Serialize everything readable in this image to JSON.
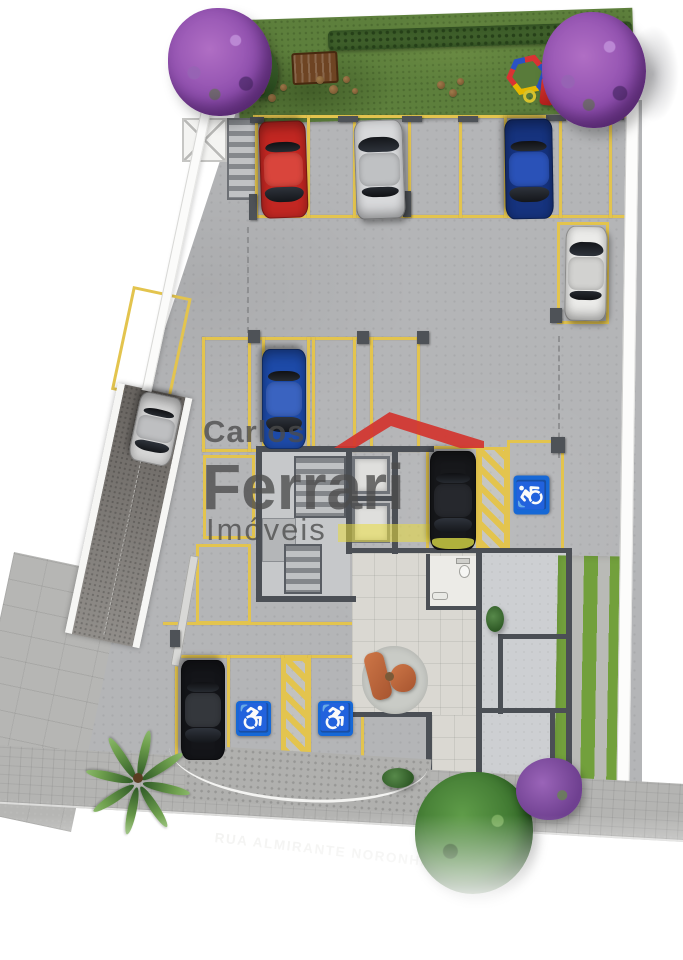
{
  "scene": {
    "type": "architectural-site-plan",
    "description": "Ground-floor parking site plan render",
    "features": [
      "lawn",
      "bench",
      "playground",
      "purple-trees",
      "parking-spots",
      "ramp",
      "stair-core",
      "elevators",
      "lobby",
      "garden-strips",
      "street"
    ]
  },
  "street": {
    "name": "RUA ALMIRANTE NORONHA"
  },
  "watermark": {
    "line1": "Carlos",
    "line2": "Ferrari",
    "line3": "Imóveis"
  },
  "accessibility": {
    "wheelchair_glyph": "♿",
    "accessible_spots": 3
  },
  "colors": {
    "line_yellow": "#e3c44e",
    "asphalt": "#b4b5b7",
    "grass": "#5d7f3c",
    "street": "#3f3f3f",
    "sidewalk": "#b4b4b2",
    "wall": "#4b4f55",
    "handicap_blue": "#1668d6",
    "logo_red": "#d2342e"
  },
  "plan": {
    "yellow_lines": [
      [
        253,
        115,
        380,
        3
      ],
      [
        253,
        215,
        380,
        3
      ],
      [
        255,
        115,
        3,
        103
      ],
      [
        307,
        115,
        3,
        103
      ],
      [
        353,
        115,
        3,
        103
      ],
      [
        408,
        115,
        3,
        103
      ],
      [
        459,
        115,
        3,
        103
      ],
      [
        504,
        115,
        3,
        103
      ],
      [
        559,
        115,
        3,
        103
      ],
      [
        609,
        115,
        3,
        103
      ],
      [
        202,
        337,
        218,
        3
      ],
      [
        202,
        449,
        218,
        3
      ],
      [
        202,
        337,
        3,
        115
      ],
      [
        248,
        337,
        3,
        115
      ],
      [
        262,
        337,
        3,
        115
      ],
      [
        307,
        337,
        3,
        115
      ],
      [
        312,
        337,
        3,
        115
      ],
      [
        353,
        337,
        3,
        115
      ],
      [
        370,
        337,
        3,
        115
      ],
      [
        417,
        337,
        3,
        115
      ],
      [
        163,
        622,
        208,
        3
      ],
      [
        175,
        655,
        195,
        3
      ],
      [
        175,
        757,
        195,
        3
      ],
      [
        175,
        655,
        3,
        105
      ],
      [
        227,
        655,
        3,
        105
      ],
      [
        281,
        655,
        3,
        105
      ],
      [
        308,
        655,
        3,
        105
      ],
      [
        361,
        655,
        3,
        105
      ]
    ],
    "spots": [
      [
        557,
        222,
        52,
        102,
        0
      ],
      [
        203,
        455,
        52,
        84,
        0
      ],
      [
        196,
        544,
        55,
        80,
        0
      ],
      [
        426,
        446,
        53,
        106,
        0
      ],
      [
        507,
        440,
        57,
        112,
        0
      ],
      [
        133,
        286,
        60,
        106,
        12
      ]
    ],
    "hatches": [
      [
        479,
        447,
        28,
        104
      ],
      [
        283,
        658,
        25,
        100
      ]
    ],
    "dashes": [
      [
        247,
        227,
        106
      ],
      [
        558,
        336,
        122
      ]
    ],
    "pillars": [
      [
        249,
        194,
        8,
        26
      ],
      [
        403,
        191,
        8,
        26
      ],
      [
        550,
        308,
        12,
        15
      ],
      [
        248,
        330,
        12,
        13
      ],
      [
        357,
        331,
        12,
        13
      ],
      [
        417,
        331,
        12,
        13
      ],
      [
        551,
        437,
        14,
        16
      ],
      [
        170,
        630,
        10,
        17
      ],
      [
        250,
        117,
        14,
        6
      ],
      [
        338,
        116,
        20,
        6
      ],
      [
        402,
        116,
        20,
        6
      ],
      [
        458,
        116,
        20,
        6
      ],
      [
        546,
        115,
        20,
        6
      ],
      [
        604,
        114,
        20,
        6
      ]
    ],
    "handicap_signs": [
      {
        "x": 236,
        "y": 701,
        "w": 35,
        "h": 35,
        "rot": 0
      },
      {
        "x": 318,
        "y": 701,
        "w": 35,
        "h": 35,
        "rot": 0
      },
      {
        "x": 512,
        "y": 477,
        "w": 39,
        "h": 36,
        "rot": -90
      }
    ],
    "cars": [
      {
        "name": "red-hatchback",
        "body": "#c22722",
        "roof": "#d9453c",
        "x": 260,
        "y": 121,
        "w": 47,
        "h": 97,
        "rot": 178
      },
      {
        "name": "silver-suv",
        "body": "#d8d9db",
        "roof": "#bfc1c3",
        "x": 355,
        "y": 120,
        "w": 49,
        "h": 99,
        "rot": -2
      },
      {
        "name": "dark-blue-sedan",
        "body": "#16337e",
        "roof": "#2a52b8",
        "x": 505,
        "y": 119,
        "w": 48,
        "h": 100,
        "rot": 179
      },
      {
        "name": "white-suv",
        "body": "#ebebe9",
        "roof": "#d2d2d0",
        "x": 565,
        "y": 226,
        "w": 42,
        "h": 95,
        "rot": 1
      },
      {
        "name": "blue-convertible",
        "body": "#1d4aa8",
        "roof": "#3a63c0",
        "x": 262,
        "y": 349,
        "w": 44,
        "h": 100,
        "rot": 180
      },
      {
        "name": "black-car-yellow-front",
        "body": "#17181b",
        "roof": "#26282d",
        "front": "#b0b13c",
        "x": 430,
        "y": 451,
        "w": 46,
        "h": 99,
        "rot": 180
      },
      {
        "name": "silver-ramp-car",
        "body": "#d6d6d6",
        "roof": "#bebfc1",
        "x": 134,
        "y": 394,
        "w": 43,
        "h": 70,
        "rot": 192
      },
      {
        "name": "black-suv",
        "body": "#141519",
        "roof": "#34373c",
        "x": 181,
        "y": 660,
        "w": 44,
        "h": 100,
        "rot": 180
      }
    ],
    "dirt_patches": [
      [
        256,
        86,
        9
      ],
      [
        268,
        94,
        8
      ],
      [
        280,
        84,
        7
      ],
      [
        316,
        76,
        8
      ],
      [
        329,
        85,
        9
      ],
      [
        343,
        76,
        7
      ],
      [
        352,
        88,
        6
      ],
      [
        437,
        81,
        8
      ],
      [
        449,
        89,
        8
      ],
      [
        457,
        78,
        7
      ]
    ],
    "vegetation": [
      {
        "kind": "tree-purple",
        "name": "purple-tree-left",
        "x": 168,
        "y": 8,
        "w": 104,
        "h": 108
      },
      {
        "kind": "tree-purple",
        "name": "purple-tree-right",
        "x": 542,
        "y": 12,
        "w": 104,
        "h": 116
      },
      {
        "kind": "tree-green",
        "name": "green-tree-street",
        "x": 415,
        "y": 772,
        "w": 118,
        "h": 122
      },
      {
        "kind": "bush-purple",
        "name": "purple-bush-street",
        "x": 516,
        "y": 758,
        "w": 66,
        "h": 62
      },
      {
        "kind": "bush-green",
        "name": "lobby-plant",
        "x": 486,
        "y": 606,
        "w": 18,
        "h": 26
      },
      {
        "kind": "bush-green",
        "name": "entry-bush",
        "x": 382,
        "y": 768,
        "w": 32,
        "h": 20
      }
    ]
  }
}
